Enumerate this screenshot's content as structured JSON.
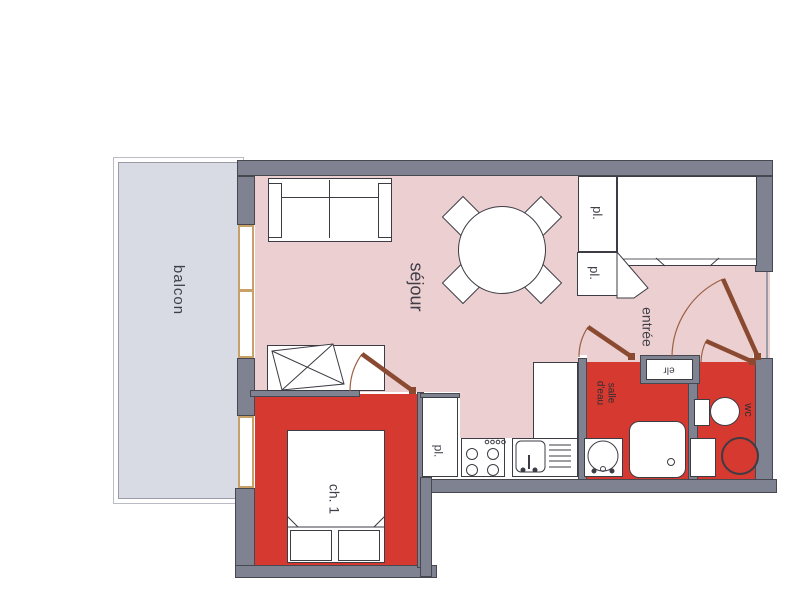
{
  "plan_title": "apartment-floor-plan",
  "rooms": {
    "balcony": {
      "label": "balcon"
    },
    "living_room": {
      "label": "séjour"
    },
    "entry": {
      "label": "entrée"
    },
    "bedroom": {
      "label": "ch. 1"
    },
    "shower_room": {
      "label_line1": "salle",
      "label_line2": "d'eau"
    },
    "toilet": {
      "label": "wc"
    },
    "closet_hall_upper": {
      "label": "pl."
    },
    "closet_hall_lower": {
      "label": "pl."
    },
    "closet_kitchen": {
      "label": "pl."
    },
    "wall_niche": {
      "label": "elr"
    }
  },
  "colors": {
    "wall": "#7f8290",
    "living_floor": "#eccfd1",
    "red_rooms": "#d6392f",
    "balcony_floor": "#d8dae4",
    "door_leaf": "#8a4a31",
    "window_frame": "#c8a169",
    "outline": "#3c3c44"
  }
}
